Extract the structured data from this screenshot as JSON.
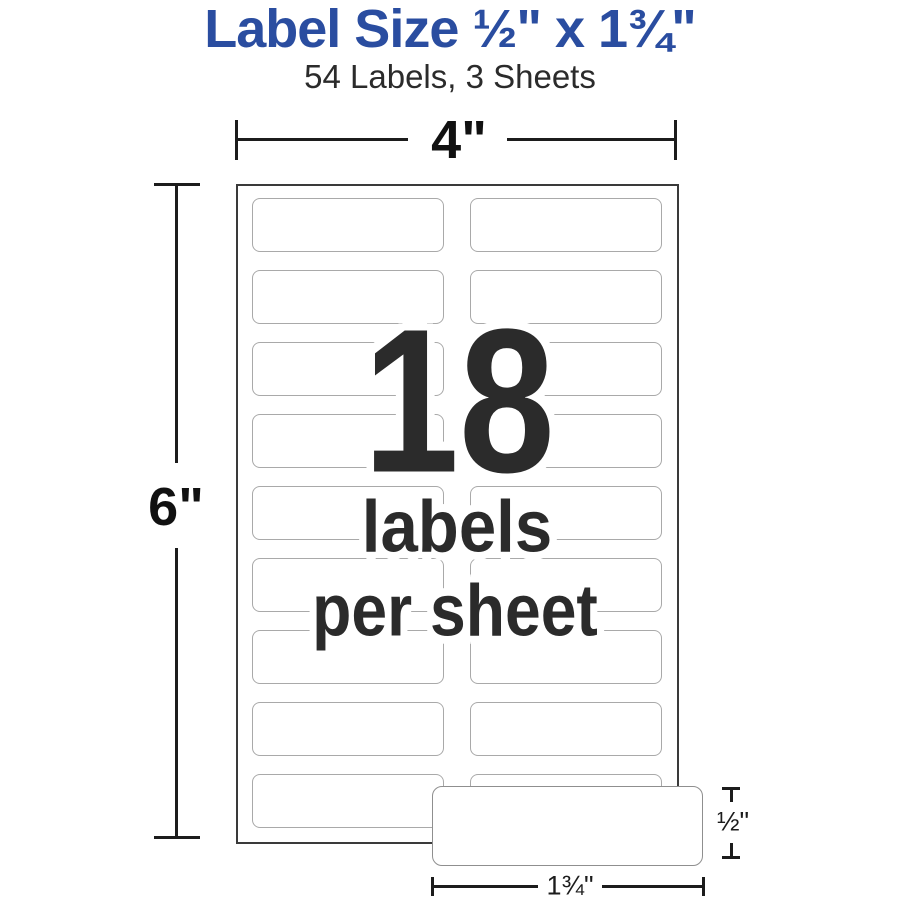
{
  "header": {
    "title": "Label Size ½\" x 1¾\"",
    "subtitle": "54 Labels, 3 Sheets"
  },
  "diagram": {
    "sheet_width": "4\"",
    "sheet_height": "6\"",
    "overlay": {
      "count": "18",
      "caption_line1": "labels",
      "caption_line2": "per sheet"
    },
    "single_label": {
      "height": "½\"",
      "width": "1¾\""
    },
    "grid": {
      "rows": 9,
      "columns": 2,
      "labels_per_sheet": 18
    }
  },
  "colors": {
    "title_blue": "#2a4da0",
    "text_dark": "#2b2b2b",
    "line_dark": "#1c1c1c",
    "sheet_border": "#3a3a3a",
    "label_border": "#a9a9a9"
  }
}
